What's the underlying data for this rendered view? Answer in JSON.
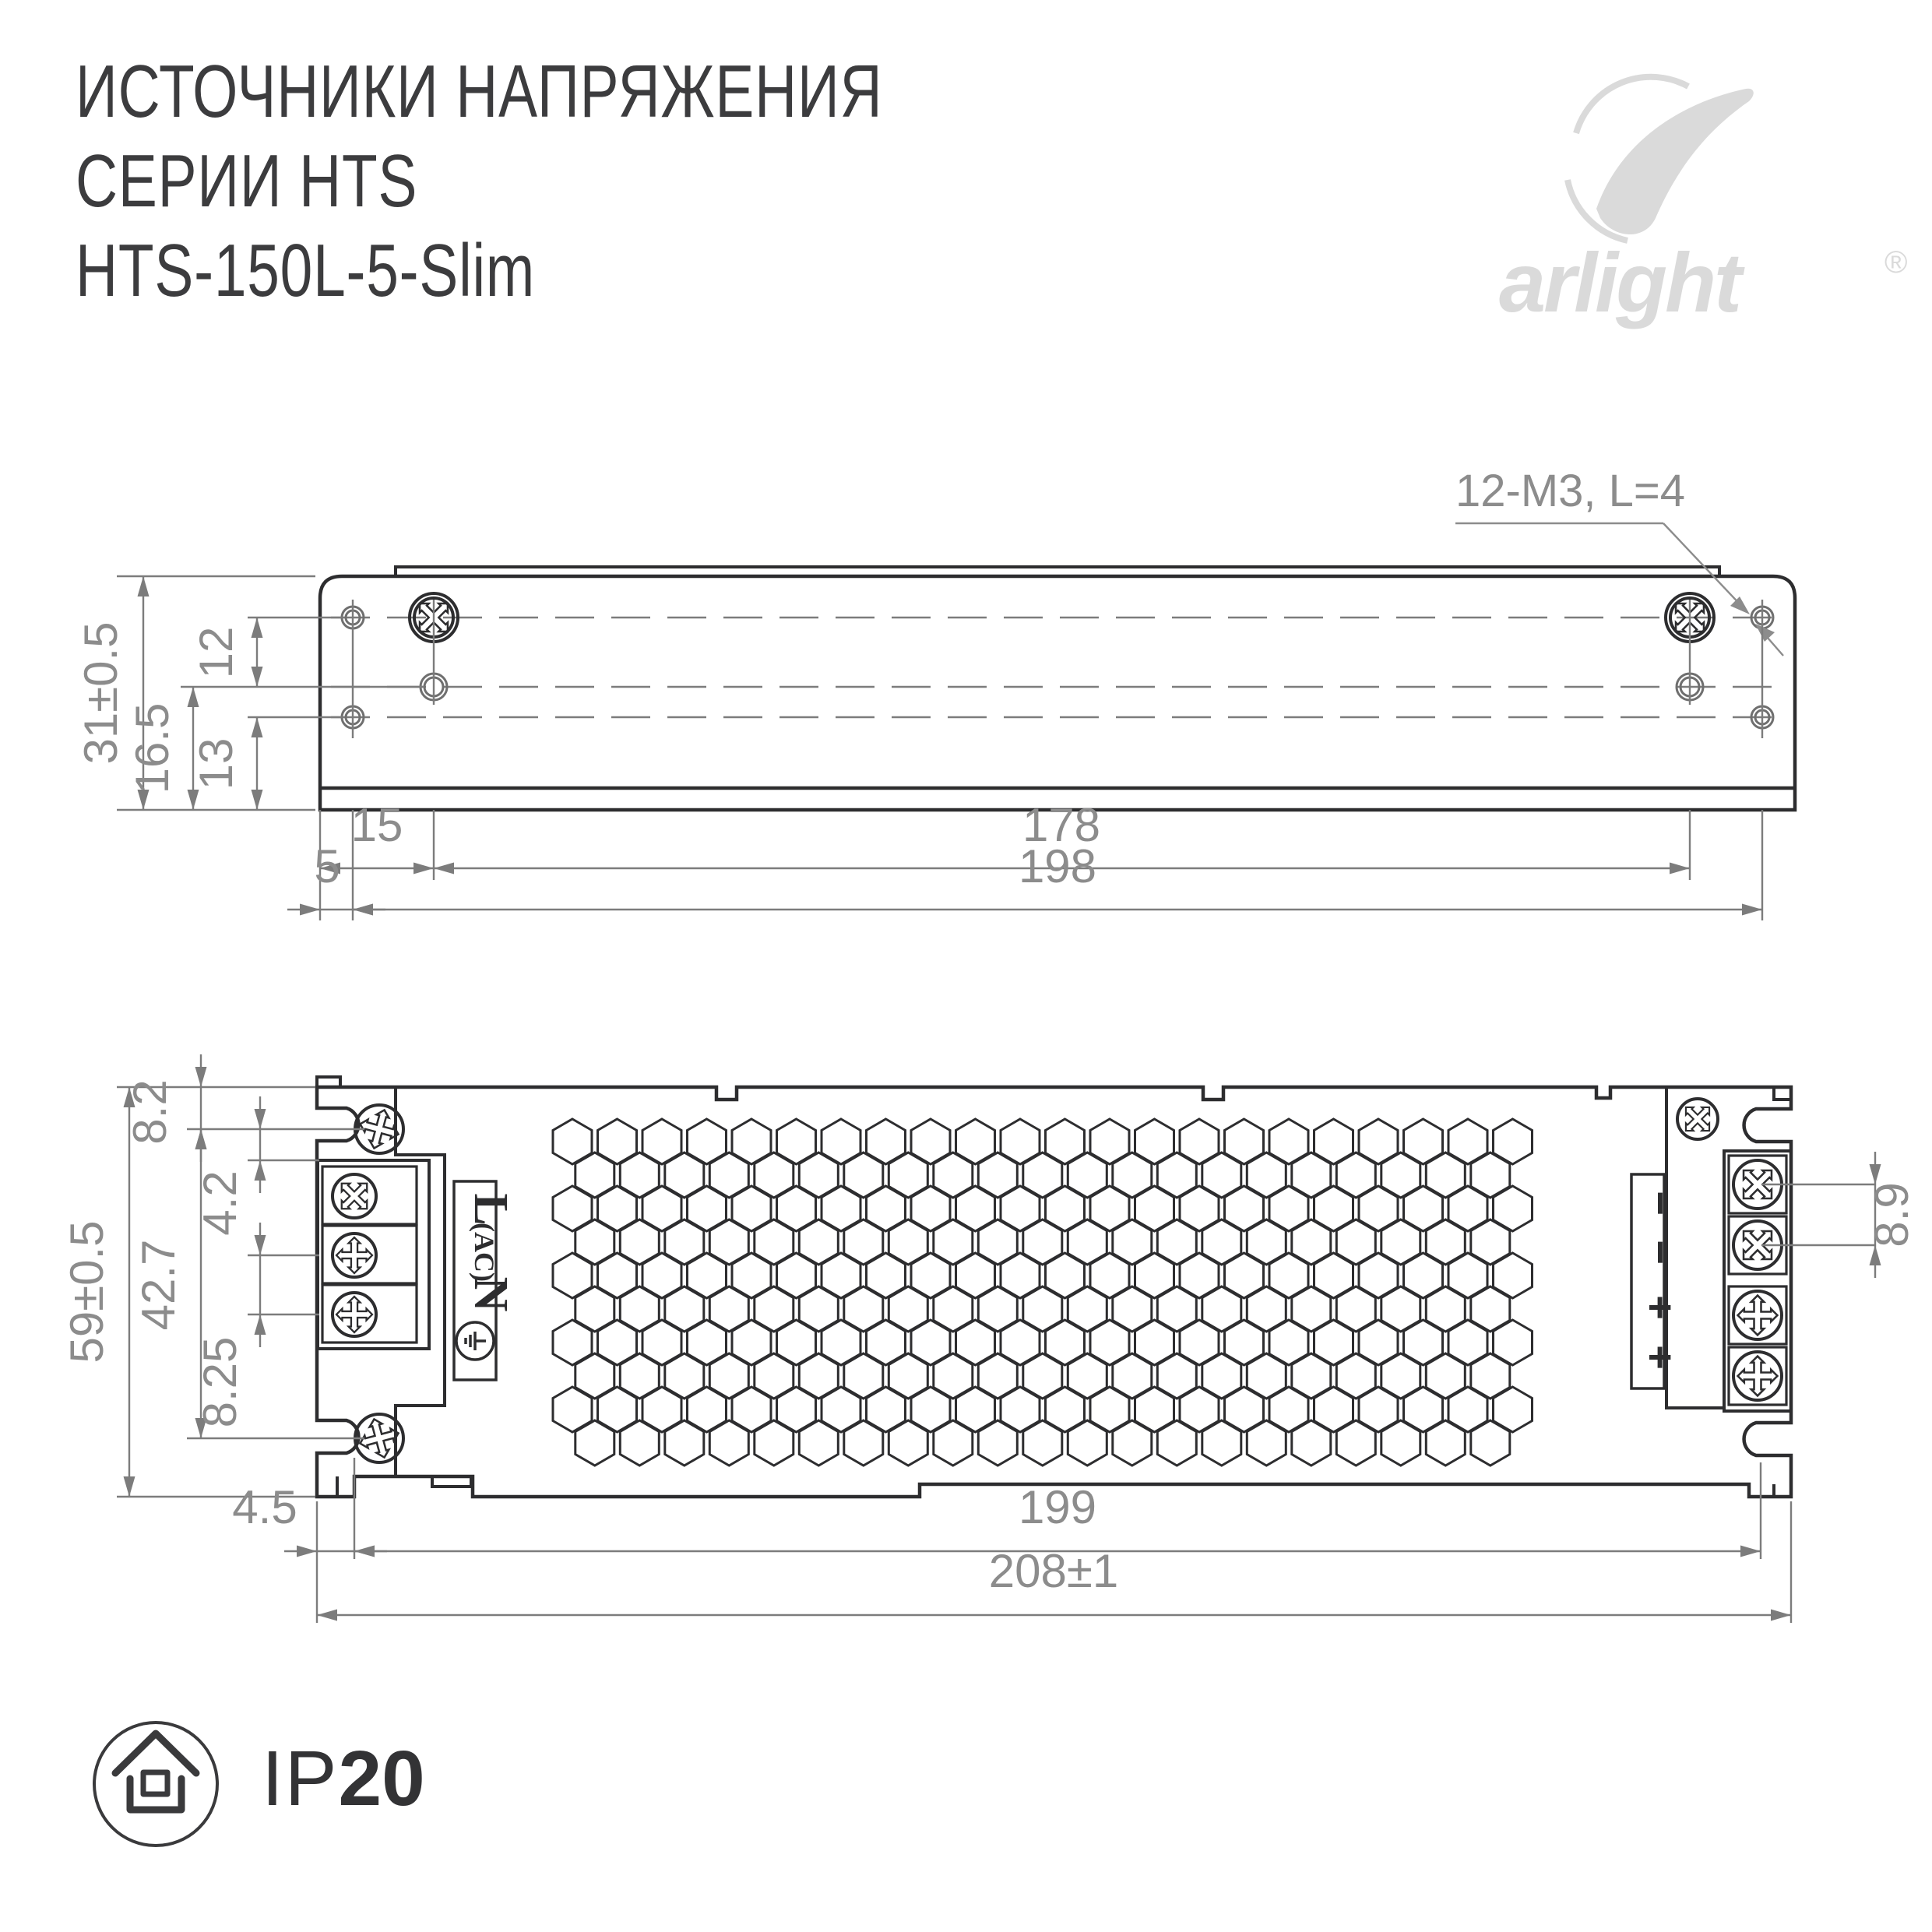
{
  "header": {
    "title_line1": "ИСТОЧНИКИ НАПРЯЖЕНИЯ",
    "title_line2": "СЕРИИ HTS",
    "title_line3": "HTS-150L-5-Slim"
  },
  "logo": {
    "brand": "arlight",
    "registered": "®"
  },
  "annotation": {
    "screw_spec": "12-M3, L=4"
  },
  "side_view": {
    "dims": {
      "height": "31±0.5",
      "row1_to_row2": "12",
      "row2_to_bottom": "16.5",
      "row3_to_bottom": "13",
      "edge_to_screw": "15",
      "screw_span": "178",
      "edge_to_hole": "5",
      "hole_span": "198"
    }
  },
  "top_view": {
    "dims": {
      "edge_to_mount": "8.2",
      "mount_to_block": "4.2",
      "mount_span": "42.7",
      "terminal_pitch": "8.25",
      "height": "59±0.5",
      "output_pitch": "8.9",
      "edge_to_mount_h": "4.5",
      "mount_span_h": "199",
      "width": "208±1"
    },
    "input_terminals": {
      "line": "L",
      "line_sub": "(AC)",
      "neutral": "N"
    },
    "output_terminals": [
      "−",
      "−",
      "+",
      "+"
    ]
  },
  "footer": {
    "ip_prefix": "IP",
    "ip_rating": "20"
  }
}
